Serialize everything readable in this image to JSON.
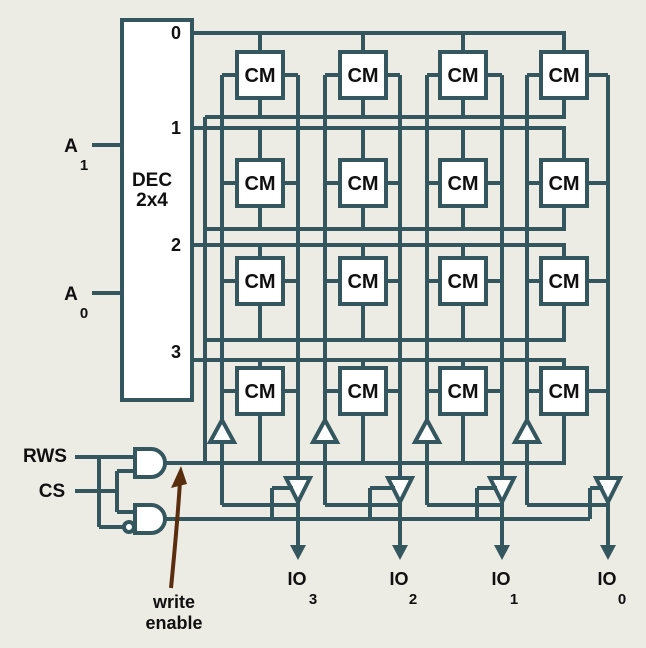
{
  "colors": {
    "wire": "#34575F",
    "background": "#EDECE4",
    "cell_fill": "#FFFFFF",
    "text": "#101010",
    "arrow": "#5A2D0E"
  },
  "decoder": {
    "title_top": "DEC",
    "title_bottom": "2x4",
    "outputs": [
      "0",
      "1",
      "2",
      "3"
    ]
  },
  "address_inputs": [
    {
      "letter": "A",
      "subscript": "1"
    },
    {
      "letter": "A",
      "subscript": "0"
    }
  ],
  "control_inputs": {
    "rws": "RWS",
    "cs": "CS"
  },
  "cell": {
    "label": "CM"
  },
  "io_pins": [
    {
      "label": "IO",
      "subscript": "3"
    },
    {
      "label": "IO",
      "subscript": "2"
    },
    {
      "label": "IO",
      "subscript": "1"
    },
    {
      "label": "IO",
      "subscript": "0"
    }
  ],
  "annotation": {
    "line1": "write",
    "line2": "enable"
  }
}
